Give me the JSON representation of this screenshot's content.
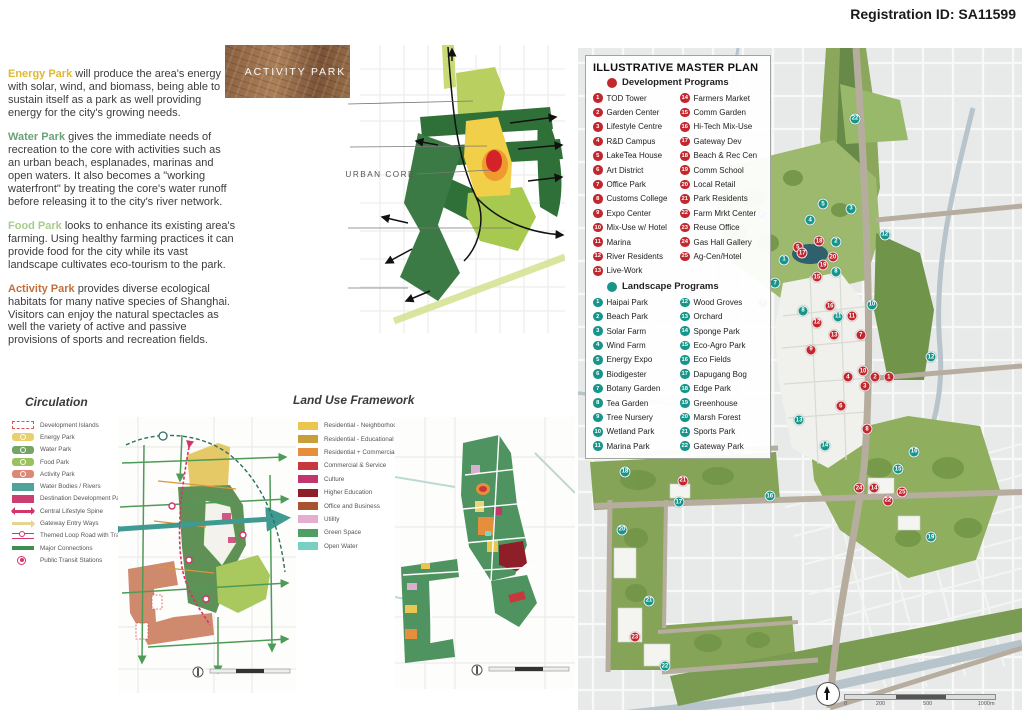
{
  "palette": {
    "dev-marker": "#c1272d",
    "land-marker": "#17958a"
  },
  "registration": "Registration ID: SA11599",
  "intro": {
    "paragraphs": [
      {
        "lead": "Energy Park",
        "color": "#e0b92e",
        "text": " will produce the area's energy with solar, wind, and biomass, being able to sustain itself as a park as well providing energy for the city's growing needs."
      },
      {
        "lead": "Water Park",
        "color": "#69a478",
        "text": " gives the immediate needs of recreation to the core with activities such as an urban beach, esplanades, marinas and open waters. It also becomes a \"working waterfront\" by treating the core's water runoff before releasing it to the city's river network."
      },
      {
        "lead": "Food Park",
        "color": "#a9cc8a",
        "text": " looks to enhance its existing area's farming. Using healthy farming practices it can provide food for the city while its vast landscape cultivates eco-tourism to the park."
      },
      {
        "lead": "Activity Park",
        "color": "#c0703d",
        "text": " provides diverse ecological habitats for many native species of Shanghai. Visitors can enjoy the natural spectacles as well the variety of active and passive provisions of sports and recreation fields."
      }
    ]
  },
  "concept": {
    "title": "Concept Framework",
    "core_label": "URBAN CORE",
    "photos": [
      {
        "label": "ENERGY PARK",
        "kind": "energy"
      },
      {
        "label": "WATER PARK",
        "kind": "water"
      },
      {
        "label": "FOOD PARK",
        "kind": "food"
      },
      {
        "label": "ACTIVITY PARK",
        "kind": "activity"
      }
    ]
  },
  "circulation": {
    "title": "Circulation",
    "legend": [
      {
        "label": "Development Islands",
        "kind": "dashed",
        "color": "#d9534f"
      },
      {
        "label": "Energy Park",
        "kind": "chip",
        "color": "#e9d06c"
      },
      {
        "label": "Water Park",
        "kind": "chip",
        "color": "#76a465"
      },
      {
        "label": "Food Park",
        "kind": "chip",
        "color": "#9cc25c"
      },
      {
        "label": "Activity Park",
        "kind": "chip",
        "color": "#dd8877"
      },
      {
        "label": "Water Bodies / Rivers",
        "kind": "rect",
        "color": "#4fa39b"
      },
      {
        "label": "Destination Development Parcels",
        "kind": "rect",
        "color": "#cc3d72"
      },
      {
        "label": "Central Lifestyle Spine",
        "kind": "arrows",
        "color": "#d6336c"
      },
      {
        "label": "Gateway Entry Ways",
        "kind": "arrow",
        "color": "#e6d494"
      },
      {
        "label": "Themed Loop Road with Tram",
        "kind": "loop",
        "color": "#d6336c"
      },
      {
        "label": "Major Connections",
        "kind": "line",
        "color": "#3e8e4d"
      },
      {
        "label": "Public Transit Stations",
        "kind": "station",
        "color": "#d6336c"
      }
    ]
  },
  "landuse": {
    "title": "Land Use Framework",
    "legend": [
      {
        "label": "Residential - Neighborhood",
        "kind": "rect",
        "color": "#e9c64f"
      },
      {
        "label": "Residential - Educational",
        "kind": "rect",
        "color": "#c79f3b"
      },
      {
        "label": "Residential + Commercial Mix Use",
        "kind": "rect",
        "color": "#e58f3d"
      },
      {
        "label": "Commercial & Service",
        "kind": "rect",
        "color": "#c8373d"
      },
      {
        "label": "Culture",
        "kind": "rect",
        "color": "#c2366e"
      },
      {
        "label": "Higher Education",
        "kind": "rect",
        "color": "#8e1f28"
      },
      {
        "label": "Office and Business",
        "kind": "rect",
        "color": "#a85430"
      },
      {
        "label": "Utility",
        "kind": "rect",
        "color": "#e5aed0"
      },
      {
        "label": "Green Space",
        "kind": "rect",
        "color": "#4f9e63"
      },
      {
        "label": "Open Water",
        "kind": "rect",
        "color": "#79cfc4"
      }
    ]
  },
  "masterplan": {
    "title": "ILLUSTRATIVE MASTER PLAN",
    "dev_header": "Development Programs",
    "land_header": "Landscape Programs",
    "dev_items": [
      {
        "n": "1",
        "label": "TOD Tower"
      },
      {
        "n": "2",
        "label": "Garden Center"
      },
      {
        "n": "3",
        "label": "Lifestyle Centre"
      },
      {
        "n": "4",
        "label": "R&D Campus"
      },
      {
        "n": "5",
        "label": "LakeTea House"
      },
      {
        "n": "6",
        "label": "Art District"
      },
      {
        "n": "7",
        "label": "Office Park"
      },
      {
        "n": "8",
        "label": "Customs College"
      },
      {
        "n": "9",
        "label": "Expo Center"
      },
      {
        "n": "10",
        "label": "Mix-Use w/ Hotel"
      },
      {
        "n": "11",
        "label": "Marina"
      },
      {
        "n": "12",
        "label": "River Residents"
      },
      {
        "n": "13",
        "label": "Live-Work"
      },
      {
        "n": "14",
        "label": "Farmers Market"
      },
      {
        "n": "15",
        "label": "Comm Garden"
      },
      {
        "n": "16",
        "label": "Hi-Tech Mix-Use"
      },
      {
        "n": "17",
        "label": "Gateway Dev"
      },
      {
        "n": "18",
        "label": "Beach & Rec Cen"
      },
      {
        "n": "19",
        "label": "Comm School"
      },
      {
        "n": "20",
        "label": "Local Retail"
      },
      {
        "n": "21",
        "label": "Park Residents"
      },
      {
        "n": "22",
        "label": "Farm Mrkt Center"
      },
      {
        "n": "23",
        "label": "Reuse Office"
      },
      {
        "n": "24",
        "label": "Gas Hall Gallery"
      },
      {
        "n": "25",
        "label": "Ag-Cen/Hotel"
      }
    ],
    "land_items": [
      {
        "n": "1",
        "label": "Haipai Park"
      },
      {
        "n": "2",
        "label": "Beach Park"
      },
      {
        "n": "3",
        "label": "Solar Farm"
      },
      {
        "n": "4",
        "label": "Wind Farm"
      },
      {
        "n": "5",
        "label": "Energy Expo"
      },
      {
        "n": "6",
        "label": "Biodigester"
      },
      {
        "n": "7",
        "label": "Botany Garden"
      },
      {
        "n": "8",
        "label": "Tea Garden"
      },
      {
        "n": "9",
        "label": "Tree Nursery"
      },
      {
        "n": "10",
        "label": "Wetland Park"
      },
      {
        "n": "11",
        "label": "Marina Park"
      },
      {
        "n": "12",
        "label": "Wood Groves"
      },
      {
        "n": "13",
        "label": "Orchard"
      },
      {
        "n": "14",
        "label": "Sponge Park"
      },
      {
        "n": "15",
        "label": "Eco-Agro Park"
      },
      {
        "n": "16",
        "label": "Eco Fields"
      },
      {
        "n": "17",
        "label": "Dapugang Bog"
      },
      {
        "n": "18",
        "label": "Edge Park"
      },
      {
        "n": "19",
        "label": "Greenhouse"
      },
      {
        "n": "20",
        "label": "Marsh Forest"
      },
      {
        "n": "21",
        "label": "Sports Park"
      },
      {
        "n": "22",
        "label": "Gateway Park"
      }
    ],
    "markers_dev": [
      {
        "n": "1",
        "x": 70.0,
        "y": 49.7
      },
      {
        "n": "2",
        "x": 66.9,
        "y": 49.7
      },
      {
        "n": "3",
        "x": 64.6,
        "y": 51.1
      },
      {
        "n": "4",
        "x": 60.8,
        "y": 49.7
      },
      {
        "n": "5",
        "x": 49.5,
        "y": 30.1
      },
      {
        "n": "6",
        "x": 59.2,
        "y": 54.1
      },
      {
        "n": "7",
        "x": 63.7,
        "y": 43.4
      },
      {
        "n": "8",
        "x": 65.1,
        "y": 57.6
      },
      {
        "n": "9",
        "x": 52.5,
        "y": 45.6
      },
      {
        "n": "10",
        "x": 64.2,
        "y": 48.8
      },
      {
        "n": "11",
        "x": 61.7,
        "y": 40.5
      },
      {
        "n": "12",
        "x": 53.8,
        "y": 41.5
      },
      {
        "n": "13",
        "x": 57.7,
        "y": 43.4
      },
      {
        "n": "14",
        "x": 66.7,
        "y": 66.5
      },
      {
        "n": "15",
        "x": 53.8,
        "y": 34.6
      },
      {
        "n": "16",
        "x": 56.8,
        "y": 39.0
      },
      {
        "n": "17",
        "x": 50.5,
        "y": 31.0
      },
      {
        "n": "18",
        "x": 54.3,
        "y": 29.2
      },
      {
        "n": "19",
        "x": 55.2,
        "y": 32.8
      },
      {
        "n": "20",
        "x": 57.4,
        "y": 31.6
      },
      {
        "n": "21",
        "x": 23.6,
        "y": 65.4
      },
      {
        "n": "22",
        "x": 69.8,
        "y": 68.4
      },
      {
        "n": "23",
        "x": 12.8,
        "y": 89.0
      },
      {
        "n": "24",
        "x": 63.3,
        "y": 66.5
      },
      {
        "n": "25",
        "x": 73.0,
        "y": 67.1
      }
    ],
    "markers_land": [
      {
        "n": "1",
        "x": 46.4,
        "y": 32.0
      },
      {
        "n": "2",
        "x": 58.1,
        "y": 29.3
      },
      {
        "n": "3",
        "x": 61.5,
        "y": 24.3
      },
      {
        "n": "4",
        "x": 52.3,
        "y": 26.0
      },
      {
        "n": "5",
        "x": 55.2,
        "y": 23.6
      },
      {
        "n": "6",
        "x": 41.4,
        "y": 25.1
      },
      {
        "n": "7",
        "x": 44.4,
        "y": 35.5
      },
      {
        "n": "8",
        "x": 58.1,
        "y": 33.8
      },
      {
        "n": "8",
        "x": 50.7,
        "y": 39.7
      },
      {
        "n": "9",
        "x": 41.7,
        "y": 38.5
      },
      {
        "n": "10",
        "x": 66.2,
        "y": 38.8
      },
      {
        "n": "11",
        "x": 58.6,
        "y": 40.6
      },
      {
        "n": "12",
        "x": 69.1,
        "y": 28.2
      },
      {
        "n": "12",
        "x": 79.5,
        "y": 46.7
      },
      {
        "n": "13",
        "x": 49.8,
        "y": 56.2
      },
      {
        "n": "14",
        "x": 55.6,
        "y": 60.1
      },
      {
        "n": "15",
        "x": 72.1,
        "y": 63.6
      },
      {
        "n": "16",
        "x": 75.7,
        "y": 61.0
      },
      {
        "n": "16",
        "x": 43.2,
        "y": 67.7
      },
      {
        "n": "17",
        "x": 22.7,
        "y": 68.6
      },
      {
        "n": "18",
        "x": 10.6,
        "y": 64.0
      },
      {
        "n": "19",
        "x": 79.5,
        "y": 73.9
      },
      {
        "n": "20",
        "x": 9.9,
        "y": 72.8
      },
      {
        "n": "21",
        "x": 16.0,
        "y": 83.5
      },
      {
        "n": "22",
        "x": 62.4,
        "y": 10.7
      },
      {
        "n": "22",
        "x": 19.6,
        "y": 93.4
      }
    ],
    "scale_labels": [
      "0",
      "200",
      "500",
      "1000m"
    ]
  }
}
